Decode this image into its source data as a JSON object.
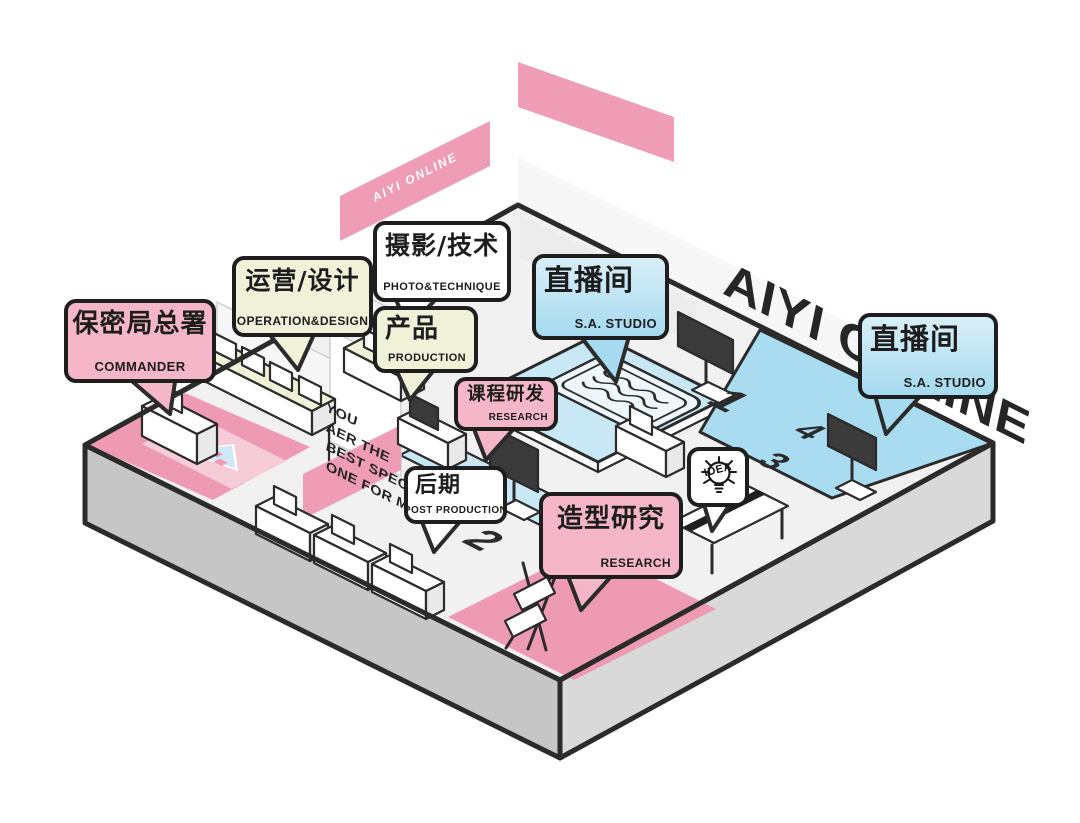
{
  "title": "AIYI ONLINE isometric office floorplan",
  "brand": {
    "big_text": "AIYI ONLINE",
    "banner_text": "AIYI ONLINE"
  },
  "quote": {
    "line1": "YOU",
    "line2": "AER THE",
    "line3": "BEST SPECIAL",
    "line4": "ONE FOR ME!"
  },
  "idea": {
    "label": "IDEA"
  },
  "floor_numbers": {
    "n1": "1",
    "n2": "2",
    "n3": "3",
    "n4": "4"
  },
  "bubbles": [
    {
      "id": "commander",
      "title": "保密局总署",
      "subtitle": "COMMANDER",
      "fill": "#f4b6c8"
    },
    {
      "id": "operation",
      "title": "运营/设计",
      "subtitle": "OPERATION&DESIGN",
      "fill": "#eff1d9"
    },
    {
      "id": "photo",
      "title": "摄影/技术",
      "subtitle": "PHOTO&TECHNIQUE",
      "fill": "#ffffff"
    },
    {
      "id": "production",
      "title": "产品",
      "subtitle": "PRODUCTION",
      "fill": "#eff1d9"
    },
    {
      "id": "studio-main",
      "title": "直播间",
      "subtitle": "S.A. STUDIO",
      "fill": "#c2e5f4"
    },
    {
      "id": "studio-right",
      "title": "直播间",
      "subtitle": "S.A. STUDIO",
      "fill": "#c2e5f4"
    },
    {
      "id": "course",
      "title": "课程研发",
      "subtitle": "RESEARCH",
      "fill": "#f4b6c8"
    },
    {
      "id": "post",
      "title": "后期",
      "subtitle": "POST PRODUCTION",
      "fill": "#ffffff"
    },
    {
      "id": "styling",
      "title": "造型研究",
      "subtitle": "RESEARCH",
      "fill": "#f4b6c8"
    }
  ],
  "colors": {
    "ink": "#1e1e1e",
    "outline": "#2b2b2b",
    "pink": "#f4b6c8",
    "pinkWall": "#ef9cb6",
    "pinkFloor": "#ef9ab5",
    "cream": "#eff1d9",
    "blue": "#a9dcf0",
    "blueLight": "#c9e8f5",
    "blueBubbleTop": "#d9eff8",
    "blueBubbleBottom": "#a5daf0",
    "grayLeft": "#c6c6c6",
    "grayRight": "#d9d9d9",
    "floorBase": "#f1f1f1",
    "tvDark": "#3a3a3a"
  }
}
